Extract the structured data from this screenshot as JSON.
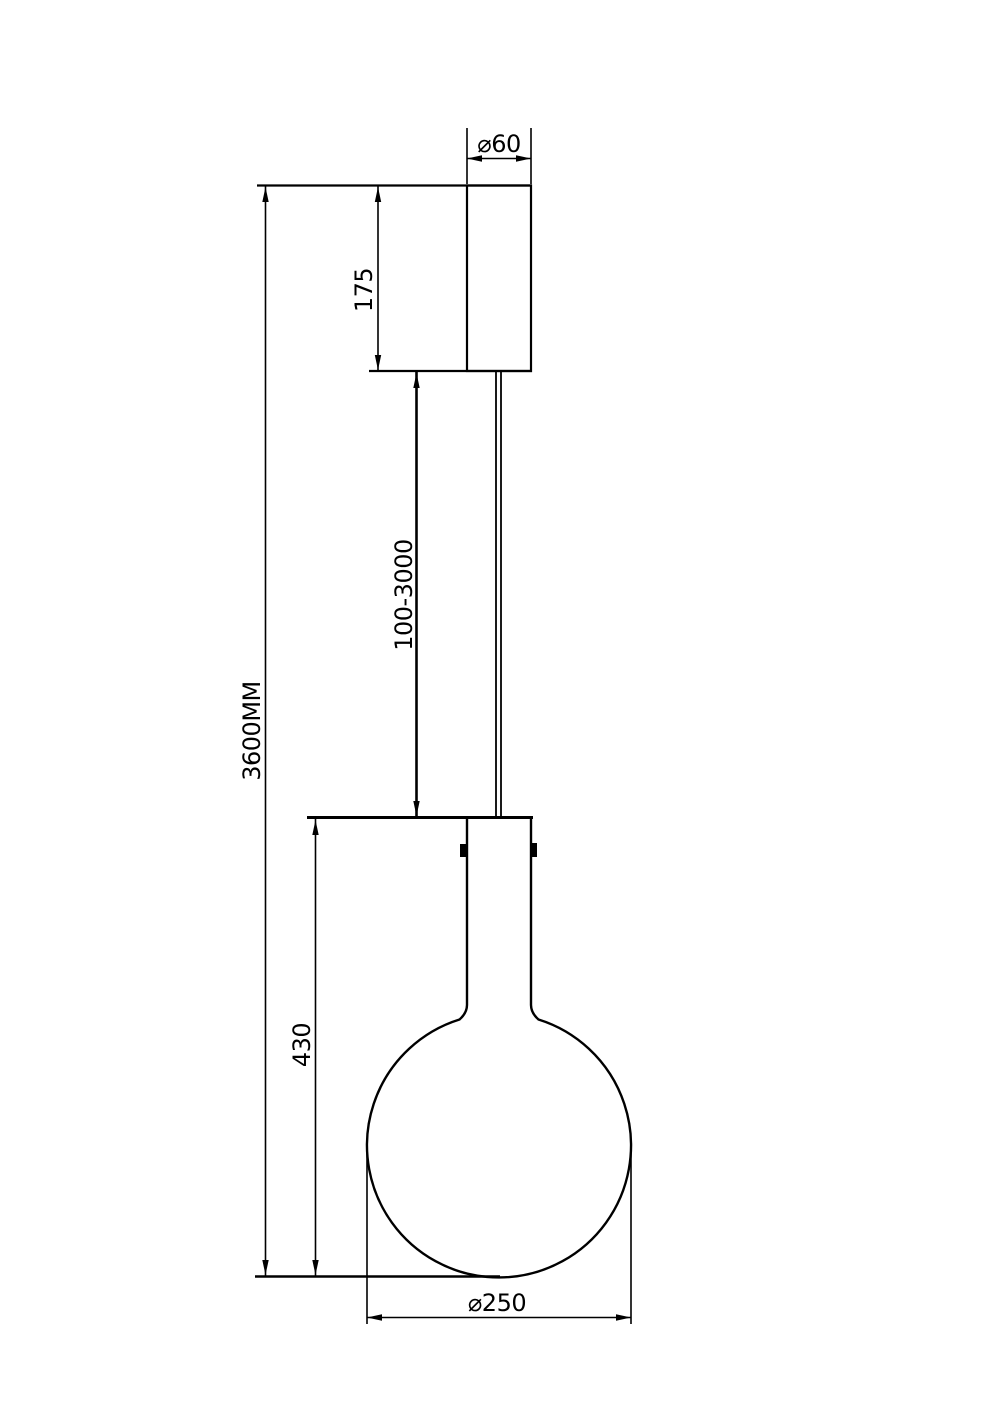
{
  "drawing": {
    "title": "Pendant lamp technical dimension drawing",
    "labels": {
      "canopy_diameter": "⌀60",
      "canopy_height": "175",
      "suspension_length": "100-3000",
      "overall_height": "3600MM",
      "lamp_body_height": "430",
      "globe_diameter": "⌀250"
    },
    "colors": {
      "line": "#000000",
      "background": "#ffffff"
    }
  }
}
